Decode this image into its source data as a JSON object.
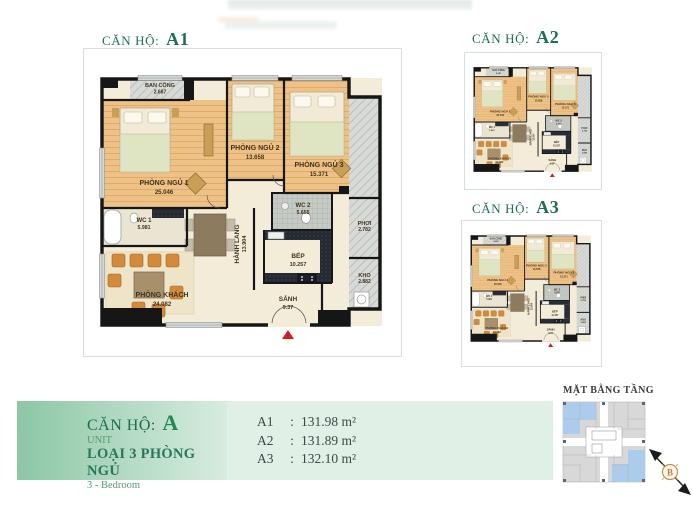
{
  "units": {
    "a1": {
      "title_label": "CĂN HỘ:",
      "title_code": "A1"
    },
    "a2": {
      "title_label": "CĂN HỘ:",
      "title_code": "A2"
    },
    "a3": {
      "title_label": "CĂN HỘ:",
      "title_code": "A3"
    }
  },
  "plan": {
    "rooms": {
      "balcony": {
        "name": "BAN CÔNG",
        "area": "2.687"
      },
      "bedroom1": {
        "name": "PHÒNG NGỦ 1",
        "area": "25.046"
      },
      "bedroom2": {
        "name": "PHÒNG NGỦ 2",
        "area": "13.658"
      },
      "bedroom3": {
        "name": "PHÒNG NGỦ 3",
        "area": "15.371"
      },
      "wc1": {
        "name": "WC 1",
        "area": "5.981"
      },
      "wc2": {
        "name": "WC 2",
        "area": "5.655"
      },
      "hallway": {
        "name": "HÀNH LANG",
        "area": "13.904"
      },
      "kitchen": {
        "name": "BẾP",
        "area": "10.257"
      },
      "living": {
        "name": "PHÒNG KHÁCH",
        "area": "24.082"
      },
      "entry": {
        "name": "SẢNH",
        "area": "9.37"
      },
      "drying": {
        "name": "PHƠI",
        "area": "2.782"
      },
      "storage": {
        "name": "KHO",
        "area": "2.882"
      }
    }
  },
  "summary": {
    "unit_label": "CĂN HỘ:",
    "unit_code": "A",
    "unit_sub": "UNIT",
    "type_label": "LOẠI 3 PHÒNG NGỦ",
    "type_en": "3 - Bedroom",
    "areas": [
      {
        "code": "A1",
        "sep": ":",
        "value": "131.98 m²"
      },
      {
        "code": "A2",
        "sep": ":",
        "value": "131.89 m²"
      },
      {
        "code": "A3",
        "sep": ":",
        "value": "132.10 m²"
      }
    ]
  },
  "floor_overview": {
    "title": "MẶT BẰNG TẦNG",
    "compass_label": "B"
  },
  "colors": {
    "title_green": "#1e6f52",
    "code_green": "#1f8a55",
    "band_gradient_start": "#8cc7a6",
    "band_gradient_end": "#e1f0e7",
    "bedroom_floor": "#eec287",
    "common_floor": "#f2ecd8",
    "wall_black": "#161616",
    "highlight_blue": "#abccea",
    "entry_red": "#cf1f1f",
    "compass_orange": "#cd8c4e"
  }
}
